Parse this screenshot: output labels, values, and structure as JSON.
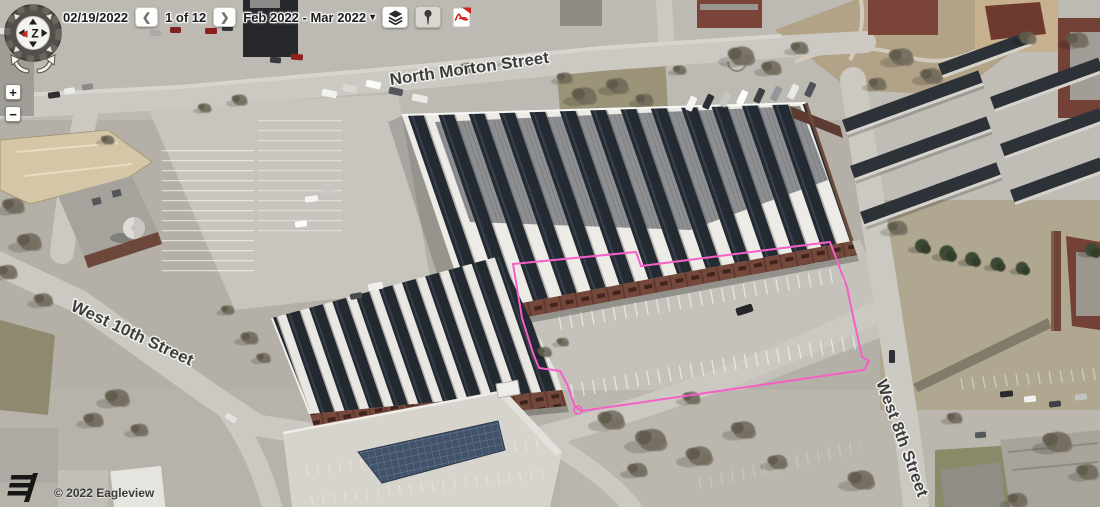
{
  "header": {
    "date": "02/19/2022",
    "prev_icon": "❮",
    "page_indicator": "1 of 12",
    "next_icon": "❯",
    "date_range": "Feb 2022 - Mar 2022",
    "caret_icon": "▾"
  },
  "controls": {
    "compass_label": "Z",
    "zoom_in": "+",
    "zoom_out": "−"
  },
  "map": {
    "streets": {
      "north": "North Morton Street",
      "west10": "West 10th Street",
      "west8": "West 8th Street"
    },
    "parcel_outline_color": "#f55fc8"
  },
  "attribution": {
    "copyright": "© 2022 Eagleview"
  }
}
